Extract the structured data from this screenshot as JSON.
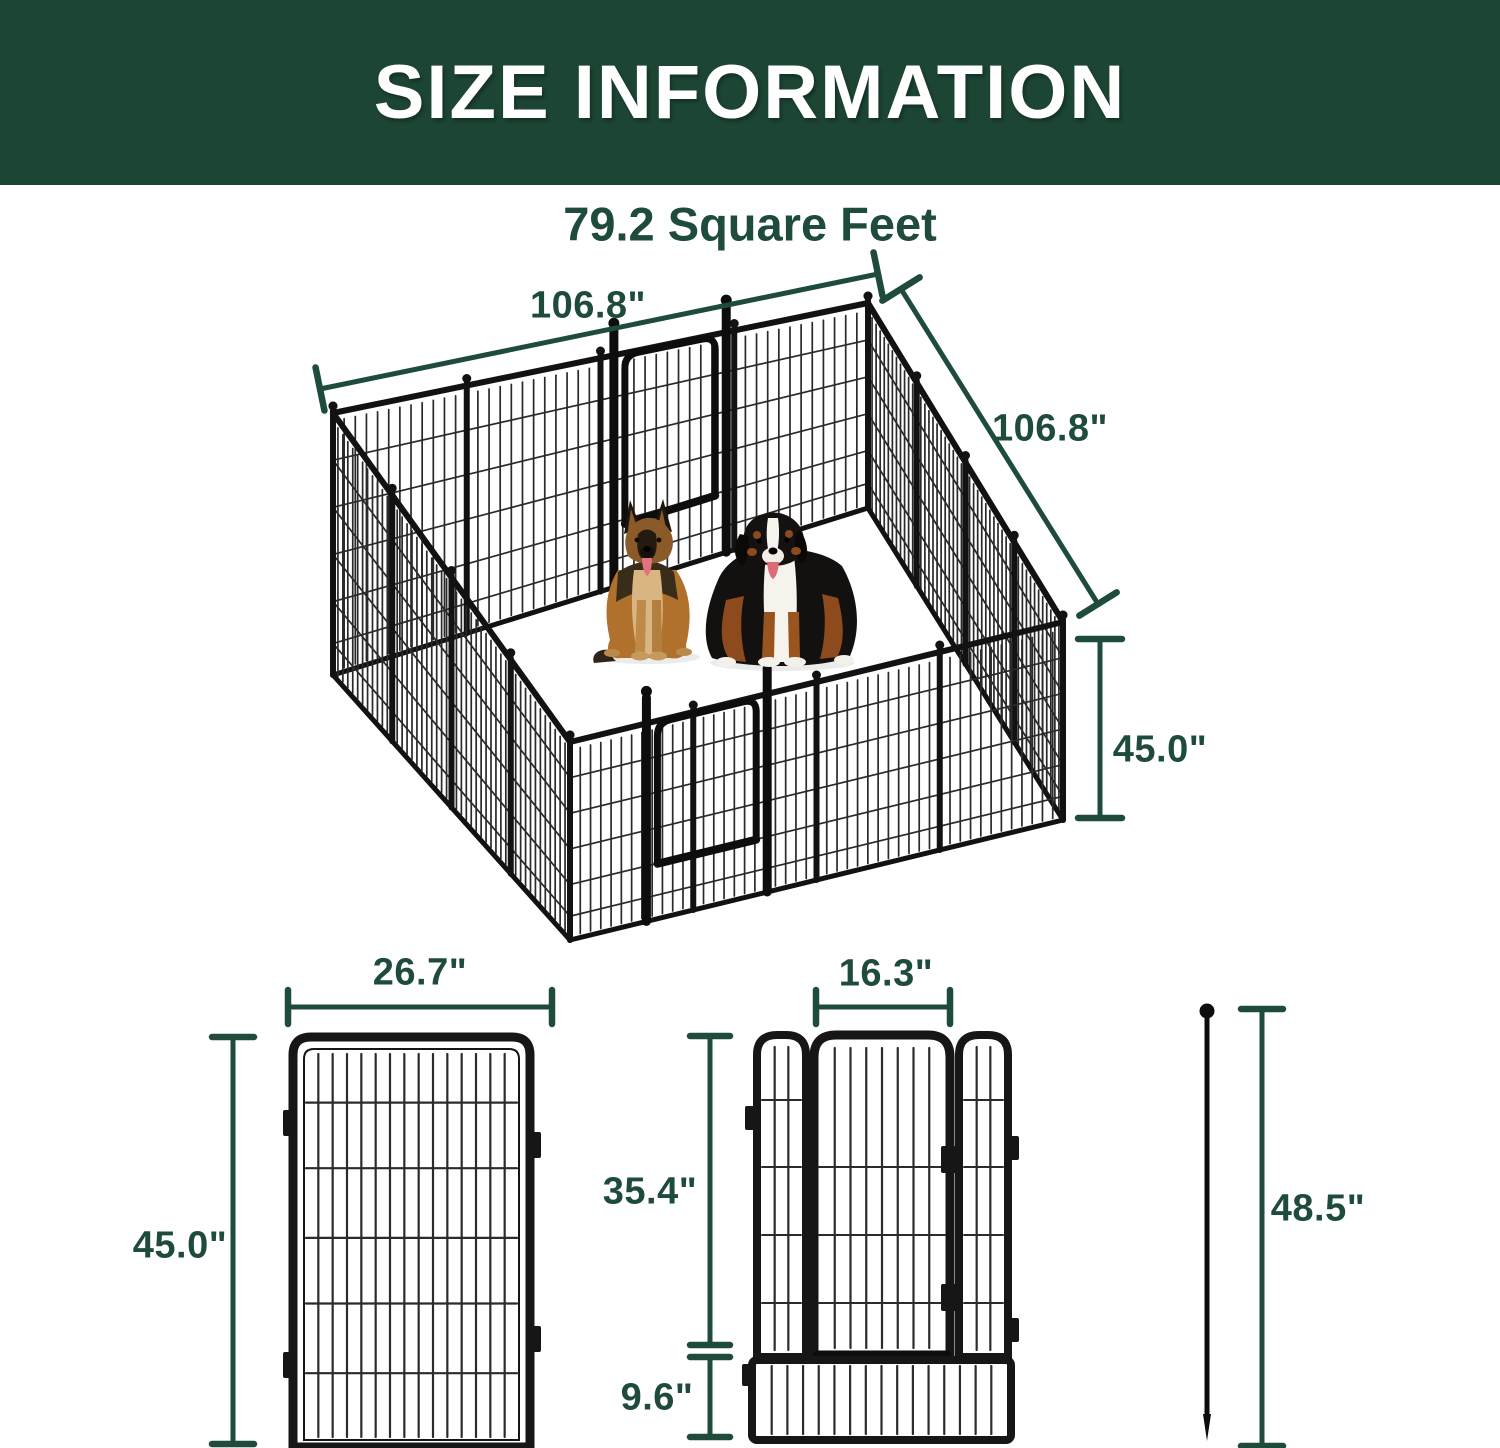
{
  "header": {
    "title": "SIZE INFORMATION"
  },
  "overview": {
    "area": "79.2 Square Feet",
    "top_width": "106.8\"",
    "side_depth": "106.8\"",
    "wall_height": "45.0\""
  },
  "panel_detail": {
    "width": "26.7\"",
    "height": "45.0\""
  },
  "door_detail": {
    "door_width": "16.3\"",
    "door_height": "35.4\"",
    "bottom_height": "9.6\""
  },
  "stake_detail": {
    "height": "48.5\""
  },
  "colors": {
    "banner_green": "#1c4533",
    "dimension_green": "#1e4b3a",
    "metal_black": "#161616"
  }
}
